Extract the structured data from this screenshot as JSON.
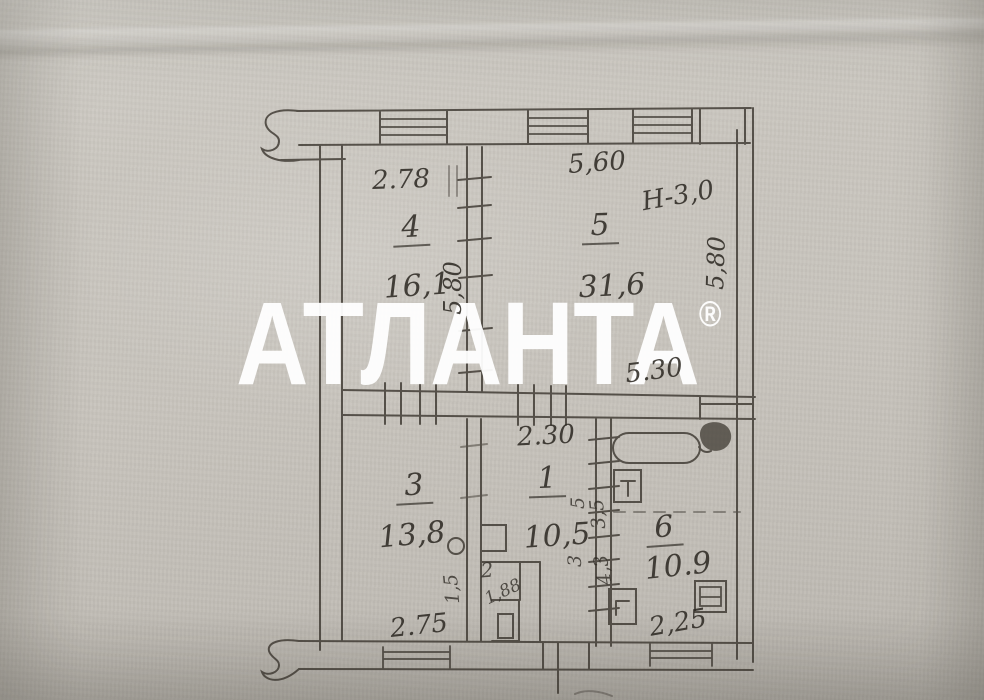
{
  "watermark": {
    "text": "АТЛАНТА",
    "reg": "®"
  },
  "plan": {
    "dims": {
      "top_left": "2.78",
      "top_right": "5,60",
      "height_note": "Н-3,0",
      "mid": "5.30",
      "hall_top": "2.30",
      "bottom_left": "2.75",
      "bottom_right": "2,25",
      "vert_left": "5,80",
      "vert_right": "5,80"
    },
    "rooms": {
      "r4": {
        "num": "4",
        "area": "16,1"
      },
      "r5": {
        "num": "5",
        "area": "31,6"
      },
      "r3": {
        "num": "3",
        "area": "13,8"
      },
      "r1": {
        "num": "1",
        "area": "10,5"
      },
      "r6": {
        "num": "6",
        "area": "10.9"
      },
      "r2": {
        "num": "2",
        "area": "1,88"
      }
    },
    "scribbles": {
      "s1": "3,5",
      "s2": "4,3",
      "s3": "1,5",
      "s4": "3",
      "s5": "5"
    }
  },
  "colors": {
    "paper": "#c8c4bd",
    "ink": "#3b372f",
    "watermark": "#ffffff"
  }
}
